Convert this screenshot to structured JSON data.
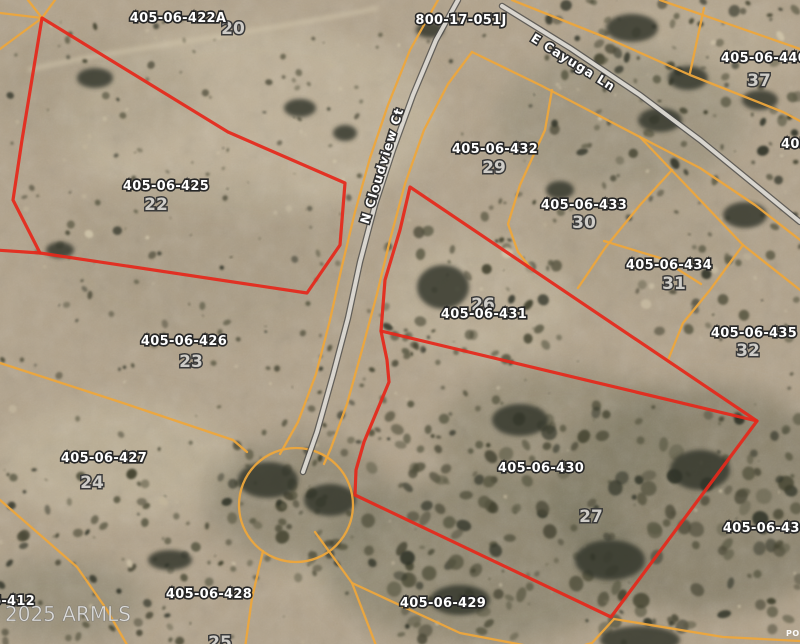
{
  "watermark": "2025 ARMLS",
  "attribution": "POWE",
  "colors": {
    "terrain_base": "#b1a28a",
    "parcel_line": "#eda63c",
    "highlight_line": "#e5281b",
    "road_fill": "#e3dfd8",
    "road_casing": "#474747",
    "label_halo": "#262626"
  },
  "streets": [
    {
      "name": "E Cayuga Ln",
      "x": 571,
      "y": 66,
      "angle": 32
    },
    {
      "name": "N Cloudview Ct",
      "x": 386,
      "y": 167,
      "angle": -73
    }
  ],
  "parcels": [
    {
      "apn": "405-06-422A",
      "x": 178,
      "y": 22,
      "lot": "20",
      "lx": 233,
      "ly": 34
    },
    {
      "apn": "800-17-051J",
      "x": 461,
      "y": 24
    },
    {
      "apn": "405-06-440",
      "x": 764,
      "y": 62,
      "lot": "37",
      "lx": 759,
      "ly": 86
    },
    {
      "apn": "405-",
      "x": 781,
      "y": 148,
      "anchor": "start"
    },
    {
      "apn": "405-06-432",
      "x": 495,
      "y": 153,
      "lot": "29",
      "lx": 494,
      "ly": 173
    },
    {
      "apn": "405-06-433",
      "x": 584,
      "y": 209,
      "lot": "30",
      "lx": 584,
      "ly": 228
    },
    {
      "apn": "405-06-434",
      "x": 669,
      "y": 269,
      "lot": "31",
      "lx": 674,
      "ly": 289
    },
    {
      "apn": "405-06-431",
      "x": 484,
      "y": 318,
      "lot": "26",
      "lx": 483,
      "ly": 310
    },
    {
      "apn": "405-06-435",
      "x": 754,
      "y": 337,
      "lot": "32",
      "lx": 748,
      "ly": 356
    },
    {
      "apn": "405-06-425",
      "x": 166,
      "y": 190,
      "lot": "22",
      "lx": 156,
      "ly": 210
    },
    {
      "apn": "405-06-426",
      "x": 184,
      "y": 345,
      "lot": "23",
      "lx": 191,
      "ly": 367
    },
    {
      "apn": "405-06-427",
      "x": 104,
      "y": 462,
      "lot": "24",
      "lx": 92,
      "ly": 488
    },
    {
      "apn": "405-06-412",
      "x": -8,
      "y": 605
    },
    {
      "apn": "405-06-428",
      "x": 209,
      "y": 598,
      "lot": "25",
      "lx": 220,
      "ly": 648
    },
    {
      "apn": "405-06-429",
      "x": 443,
      "y": 607
    },
    {
      "apn": "405-06-430",
      "x": 541,
      "y": 472,
      "lot": "27",
      "lx": 591,
      "ly": 522
    },
    {
      "apn": "405-06-436",
      "x": 766,
      "y": 532
    }
  ],
  "map_data": {
    "roads": {
      "cayuga": [
        [
          502,
          6
        ],
        [
          570,
          48
        ],
        [
          640,
          95
        ],
        [
          700,
          140
        ],
        [
          755,
          185
        ],
        [
          800,
          222
        ]
      ],
      "cloudview": [
        [
          458,
          0
        ],
        [
          436,
          40
        ],
        [
          413,
          95
        ],
        [
          393,
          150
        ],
        [
          375,
          205
        ],
        [
          360,
          262
        ],
        [
          348,
          318
        ],
        [
          333,
          375
        ],
        [
          317,
          432
        ],
        [
          303,
          472
        ]
      ]
    },
    "cul_de_sac": {
      "cx": 296,
      "cy": 505,
      "r": 57
    },
    "yellow_lines": [
      [
        [
          0,
          13
        ],
        [
          42,
          18
        ]
      ],
      [
        [
          42,
          18
        ],
        [
          28,
          0
        ]
      ],
      [
        [
          42,
          18
        ],
        [
          55,
          0
        ]
      ],
      [
        [
          42,
          18
        ],
        [
          0,
          49
        ]
      ],
      [
        [
          438,
          0
        ],
        [
          410,
          50
        ],
        [
          388,
          105
        ],
        [
          370,
          158
        ],
        [
          355,
          212
        ],
        [
          342,
          266
        ],
        [
          330,
          320
        ],
        [
          316,
          374
        ],
        [
          298,
          422
        ],
        [
          280,
          454
        ]
      ],
      [
        [
          472,
          52
        ],
        [
          448,
          84
        ],
        [
          424,
          130
        ],
        [
          405,
          184
        ],
        [
          390,
          240
        ],
        [
          377,
          294
        ],
        [
          362,
          350
        ],
        [
          347,
          404
        ],
        [
          331,
          448
        ],
        [
          324,
          464
        ]
      ],
      [
        [
          472,
          52
        ],
        [
          540,
          85
        ],
        [
          640,
          137
        ],
        [
          700,
          168
        ],
        [
          755,
          205
        ],
        [
          800,
          240
        ]
      ],
      [
        [
          512,
          0
        ],
        [
          607,
          38
        ],
        [
          690,
          75
        ],
        [
          783,
          112
        ],
        [
          800,
          121
        ]
      ],
      [
        [
          660,
          0
        ],
        [
          800,
          49
        ]
      ],
      [
        [
          704,
          8
        ],
        [
          690,
          73
        ]
      ],
      [
        [
          640,
          137
        ],
        [
          743,
          245
        ]
      ],
      [
        [
          743,
          245
        ],
        [
          710,
          290
        ],
        [
          683,
          323
        ],
        [
          668,
          360
        ]
      ],
      [
        [
          743,
          245
        ],
        [
          800,
          290
        ]
      ],
      [
        [
          552,
          90
        ],
        [
          545,
          130
        ],
        [
          520,
          185
        ],
        [
          508,
          224
        ],
        [
          518,
          252
        ],
        [
          532,
          270
        ]
      ],
      [
        [
          672,
          170
        ],
        [
          640,
          205
        ],
        [
          605,
          248
        ],
        [
          578,
          288
        ]
      ],
      [
        [
          604,
          241
        ],
        [
          660,
          258
        ],
        [
          701,
          284
        ]
      ],
      [
        [
          0,
          363
        ],
        [
          120,
          402
        ],
        [
          233,
          440
        ],
        [
          247,
          452
        ]
      ],
      [
        [
          0,
          500
        ],
        [
          77,
          567
        ],
        [
          107,
          610
        ],
        [
          130,
          650
        ]
      ],
      [
        [
          263,
          551
        ],
        [
          252,
          598
        ],
        [
          245,
          648
        ]
      ],
      [
        [
          315,
          532
        ],
        [
          352,
          583
        ],
        [
          460,
          633
        ],
        [
          560,
          652
        ],
        [
          592,
          643
        ],
        [
          614,
          619
        ]
      ],
      [
        [
          352,
          583
        ],
        [
          377,
          648
        ]
      ],
      [
        [
          614,
          619
        ],
        [
          723,
          637
        ],
        [
          800,
          641
        ]
      ]
    ],
    "red_polygons": [
      [
        [
          42,
          18
        ],
        [
          228,
          132
        ],
        [
          345,
          183
        ],
        [
          340,
          245
        ],
        [
          307,
          293
        ],
        [
          40,
          253
        ],
        [
          13,
          200
        ],
        [
          22,
          140
        ]
      ],
      [
        [
          410,
          187
        ],
        [
          757,
          421
        ],
        [
          611,
          617
        ],
        [
          355,
          495
        ],
        [
          356,
          470
        ],
        [
          364,
          442
        ],
        [
          389,
          382
        ],
        [
          387,
          360
        ],
        [
          381,
          331
        ],
        [
          385,
          280
        ],
        [
          400,
          230
        ]
      ]
    ],
    "red_lines": [
      [
        [
          40,
          253
        ],
        [
          -5,
          250
        ]
      ],
      [
        [
          381,
          331
        ],
        [
          757,
          421
        ]
      ]
    ]
  }
}
